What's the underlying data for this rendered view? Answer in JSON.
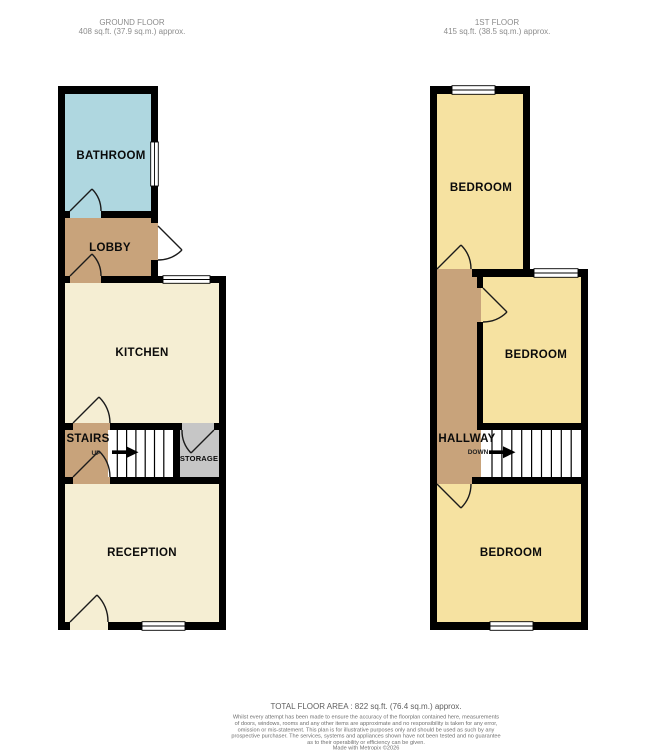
{
  "colors": {
    "wall": "#000000",
    "bathroom": "#afd7e0",
    "lobby": "#c8a37b",
    "hallway": "#c8a37b",
    "stairs_landing": "#c8a37b",
    "kitchen": "#f5eed3",
    "reception": "#f5eed3",
    "bedroom": "#f6e2a1",
    "storage": "#c6c6c6",
    "stair_treads": "#ffffff",
    "window": "#ffffff"
  },
  "floors": {
    "ground": {
      "title": "GROUND FLOOR",
      "area": "408 sq.ft. (37.9 sq.m.) approx.",
      "rooms": {
        "bathroom": "BATHROOM",
        "lobby": "LOBBY",
        "kitchen": "KITCHEN",
        "stairs": "STAIRS",
        "stairs_direction": "UP",
        "storage": "STORAGE",
        "reception": "RECEPTION"
      }
    },
    "first": {
      "title": "1ST FLOOR",
      "area": "415 sq.ft. (38.5 sq.m.) approx.",
      "rooms": {
        "bedroom_front": "BEDROOM",
        "bedroom_middle": "BEDROOM",
        "hallway": "HALLWAY",
        "stairs_direction": "DOWN",
        "bedroom_back": "BEDROOM"
      }
    }
  },
  "footer": {
    "total_area": "TOTAL FLOOR AREA : 822 sq.ft. (76.4 sq.m.) approx.",
    "disclaimer_lines": [
      "Whilst every attempt has been made to ensure the accuracy of the floorplan contained here, measurements",
      "of doors, windows, rooms and any other items are approximate and no responsibility is taken for any error,",
      "omission or mis-statement. This plan is for illustrative purposes only and should be used as such by any",
      "prospective purchaser. The services, systems and appliances shown have not been tested and no guarantee",
      "as to their operability or efficiency can be given."
    ],
    "credit": "Made with Metropix ©2026"
  }
}
